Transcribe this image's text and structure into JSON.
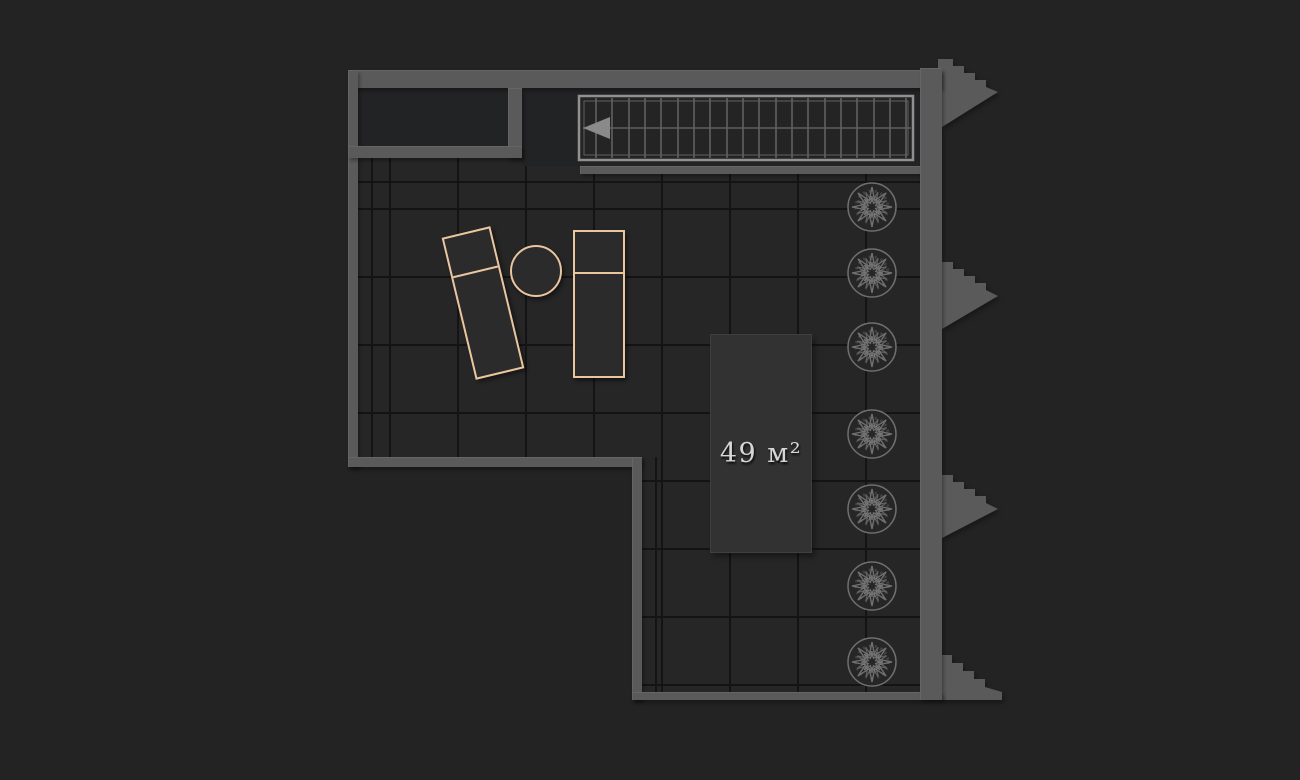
{
  "plan": {
    "area_label": "49 м²",
    "colors": {
      "background": "#232323",
      "floor": "#262626",
      "grid_line": "#141414",
      "wall": "#5a5a5a",
      "stair_outline": "#909090",
      "tree_outline": "#6f6f6f",
      "furniture_outline": "#eac69f",
      "area_label_text": "#d6d6d6"
    },
    "staircase": {
      "tread_count": 20,
      "arrow_direction": "left"
    },
    "counts": {
      "trees": 7,
      "loungers": 2,
      "side_tables": 1,
      "exterior_step_flights": 4
    }
  }
}
